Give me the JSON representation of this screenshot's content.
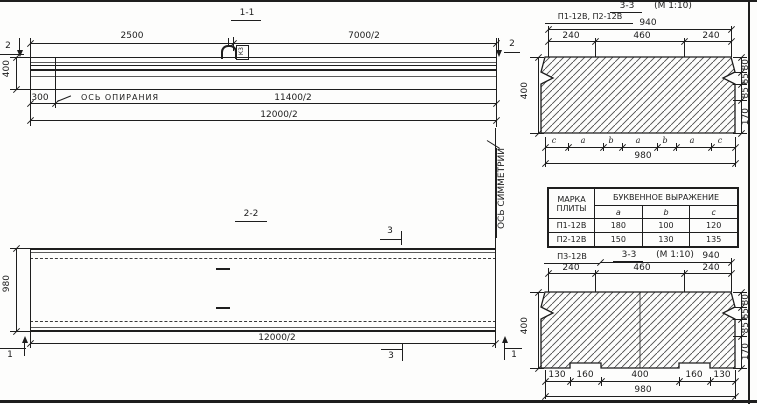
{
  "section_1_1": {
    "title": "1-1",
    "cut_label_left": "2",
    "cut_label_right": "2",
    "dim_top_left": "2500",
    "dim_top_right": "7000/2",
    "dim_height": "400",
    "dim_offset": "300",
    "bearing_axis_label": "ОСЬ ОПИРАНИЯ",
    "dim_half_span": "11400/2",
    "dim_total": "12000/2",
    "loop_mark": "К3"
  },
  "section_2_2": {
    "title": "2-2",
    "dim_width": "980",
    "dim_total": "12000/2",
    "cut_label_3_top": "3",
    "cut_label_3_bottom": "3",
    "cut_label_1_left": "1",
    "cut_label_1_right": "1",
    "symmetry_axis_label": "ОСЬ СИММЕТРИИ"
  },
  "section_3_3_top": {
    "plates_label": "П1-12В, П2-12В",
    "title_section": "3-3",
    "title_scale": "(М 1:10)",
    "dim_940": "940",
    "dims_top": [
      "240",
      "460",
      "240"
    ],
    "dim_height": "400",
    "dims_right": [
      "80",
      "65",
      "85",
      "170"
    ],
    "segment_letters": [
      "c",
      "a",
      "b",
      "a",
      "b",
      "a",
      "c"
    ],
    "dim_980": "980"
  },
  "plate_table": {
    "col1_line1": "МАРКА",
    "col1_line2": "ПЛИТЫ",
    "expr_header": "БУКВЕННОЕ  ВЫРАЖЕНИЕ",
    "letter_cols": [
      "a",
      "b",
      "c"
    ],
    "rows": [
      {
        "mark": "П1-12В",
        "a": "180",
        "b": "100",
        "c": "120"
      },
      {
        "mark": "П2-12В",
        "a": "150",
        "b": "130",
        "c": "135"
      }
    ]
  },
  "section_3_3_bottom": {
    "plate_label": "П3-12В",
    "title_section": "3-3",
    "title_scale": "(М 1:10)",
    "dim_940": "940",
    "dims_top": [
      "240",
      "460",
      "240"
    ],
    "dim_height": "400",
    "dims_right": [
      "80",
      "65",
      "85",
      "170"
    ],
    "dims_bottom": [
      "130",
      "160",
      "400",
      "160",
      "130"
    ],
    "dim_980": "980"
  }
}
